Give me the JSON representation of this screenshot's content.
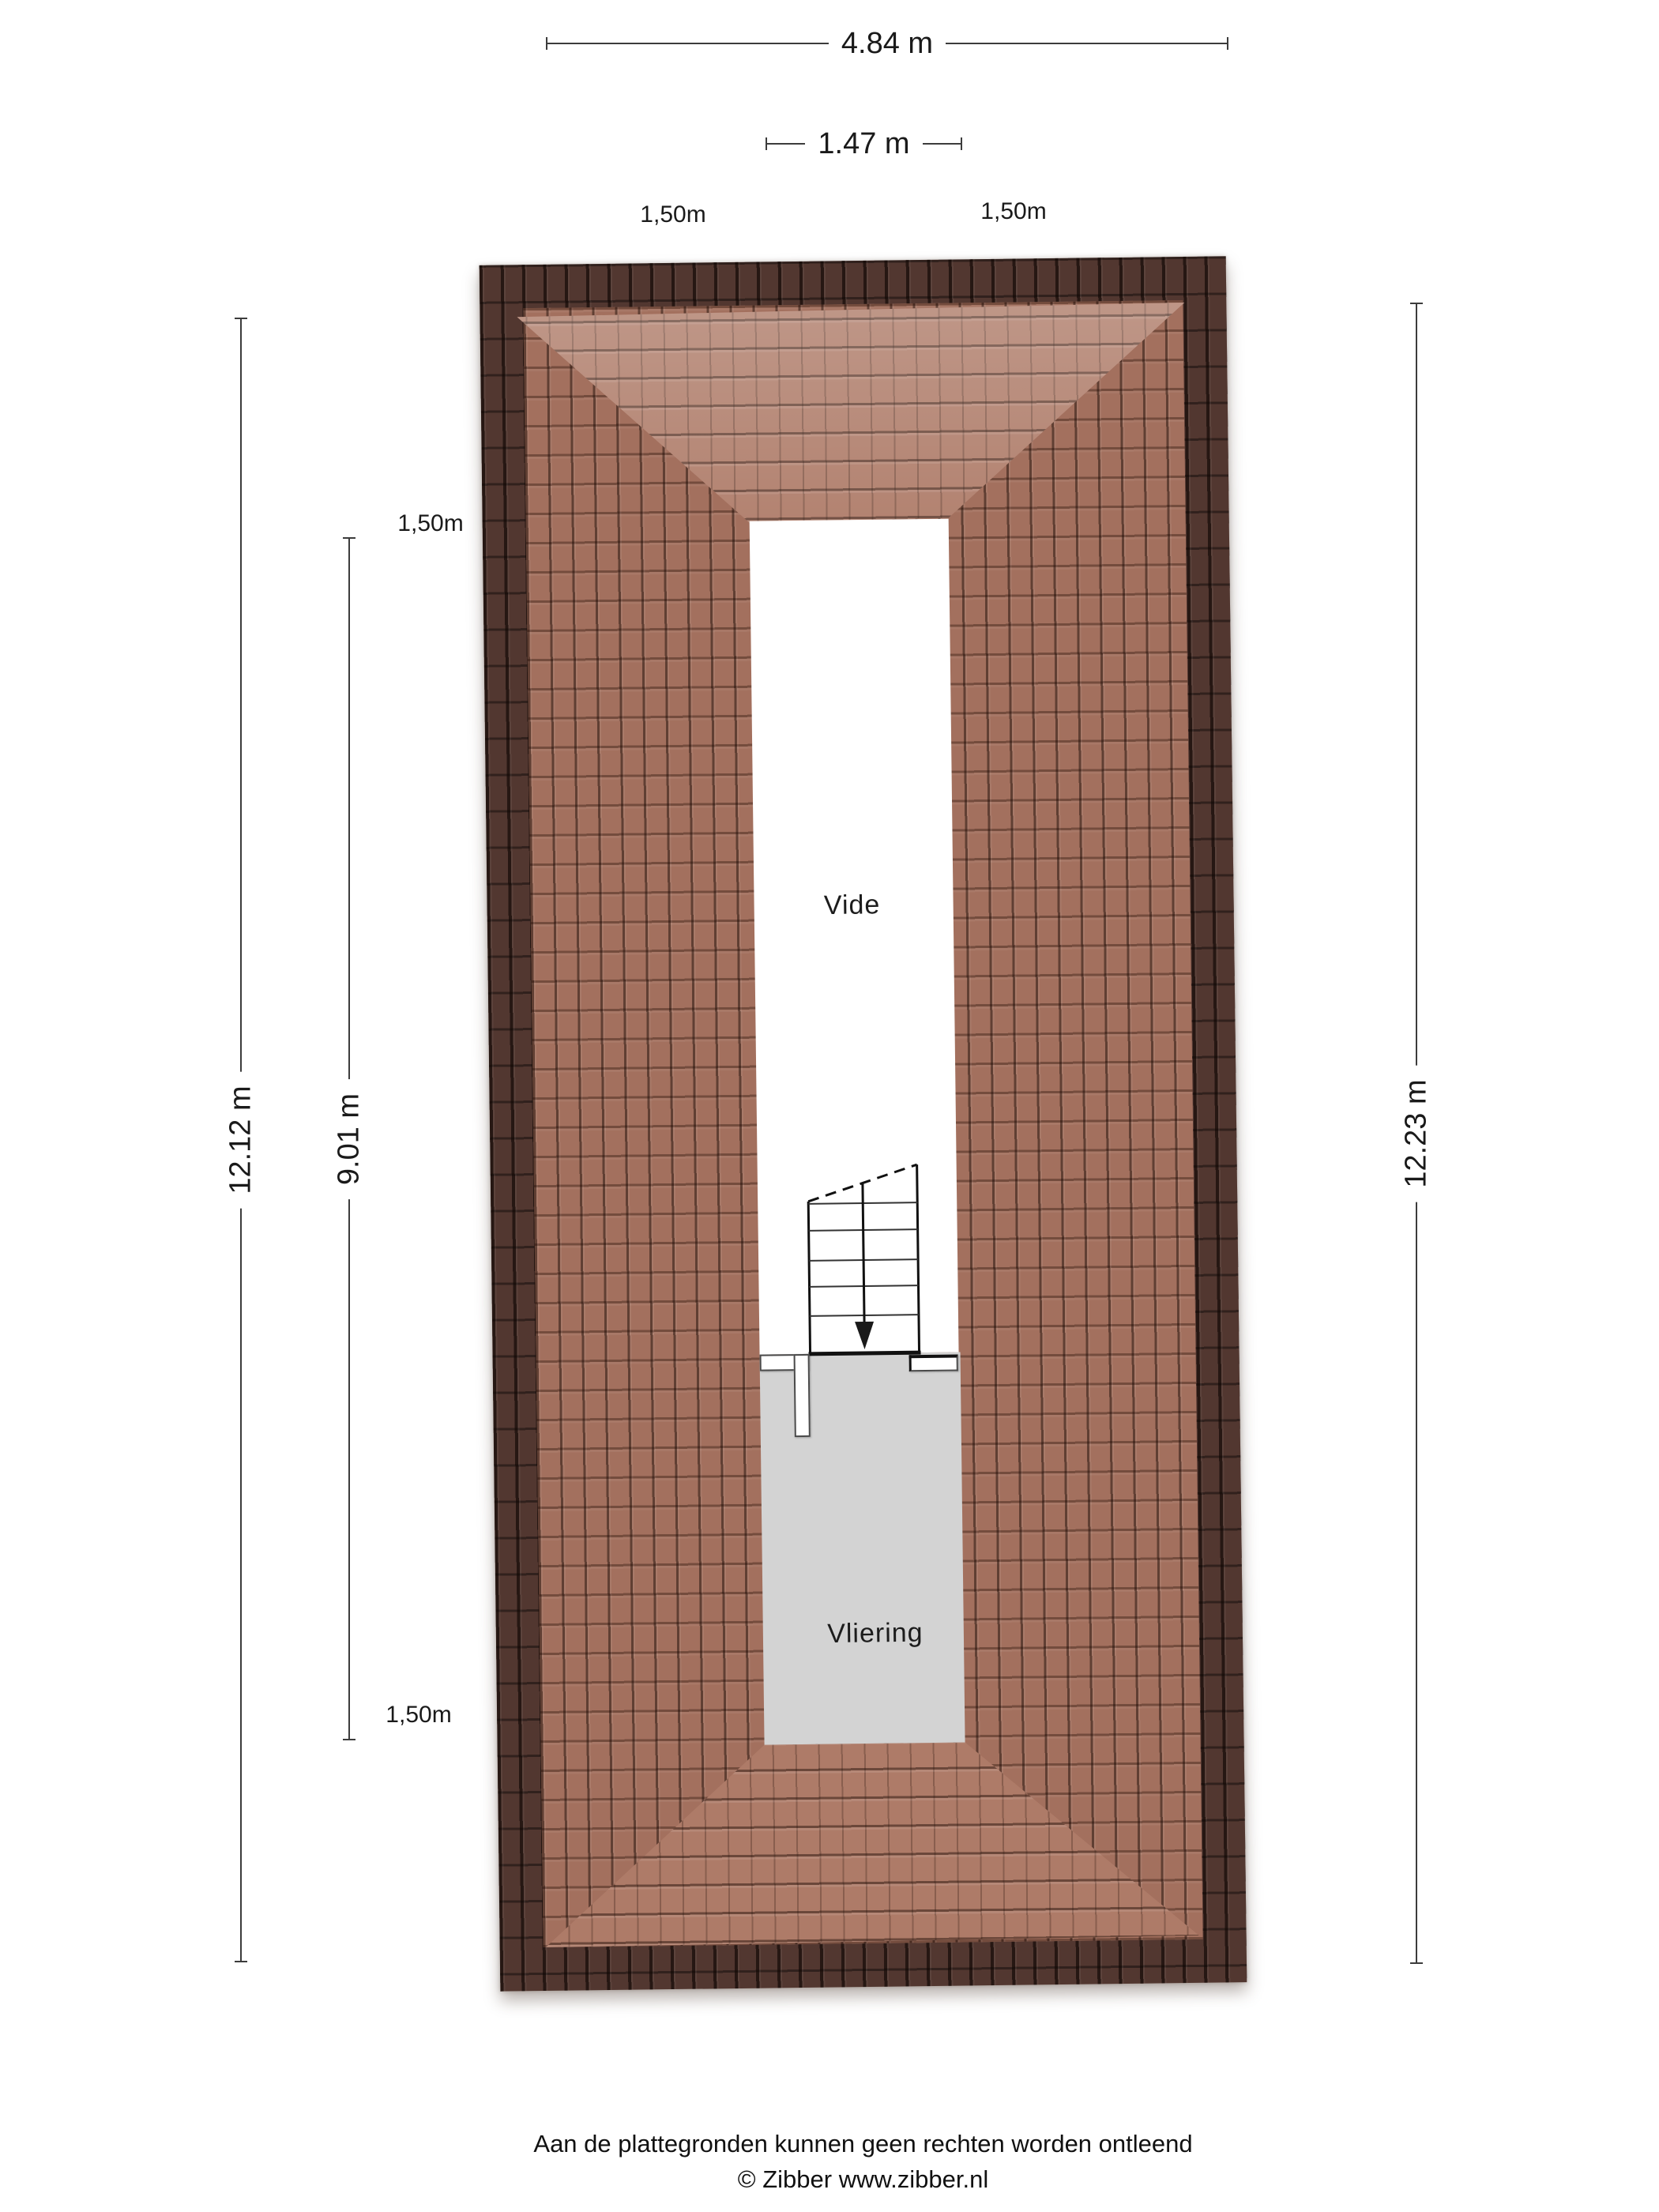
{
  "dimensions": {
    "top_outer": {
      "label": "4.84 m"
    },
    "top_inner": {
      "label": "1.47 m"
    },
    "offset_top_left": {
      "label": "1,50m"
    },
    "offset_top_right": {
      "label": "1,50m"
    },
    "left_outer": {
      "label": "12.12 m"
    },
    "left_inner": {
      "label": "9.01 m"
    },
    "offset_left_upper": {
      "label": "1,50m"
    },
    "offset_left_lower": {
      "label": "1,50m"
    },
    "right_outer": {
      "label": "12.23 m"
    }
  },
  "rooms": {
    "vide": {
      "label": "Vide"
    },
    "vliering": {
      "label": "Vliering"
    }
  },
  "footer": {
    "disclaimer": "Aan de plattegronden kunnen geen rechten worden ontleend",
    "copyright": "© Zibber www.zibber.nl"
  },
  "colors": {
    "roof_ridge_dark": "#523730",
    "roof_tile_main": "#a3705e",
    "roof_tile_light": "#ae7b68",
    "floor_gray": "#d3d3d3",
    "dimension_line": "#3c3c3c",
    "text": "#1a1a1a"
  }
}
